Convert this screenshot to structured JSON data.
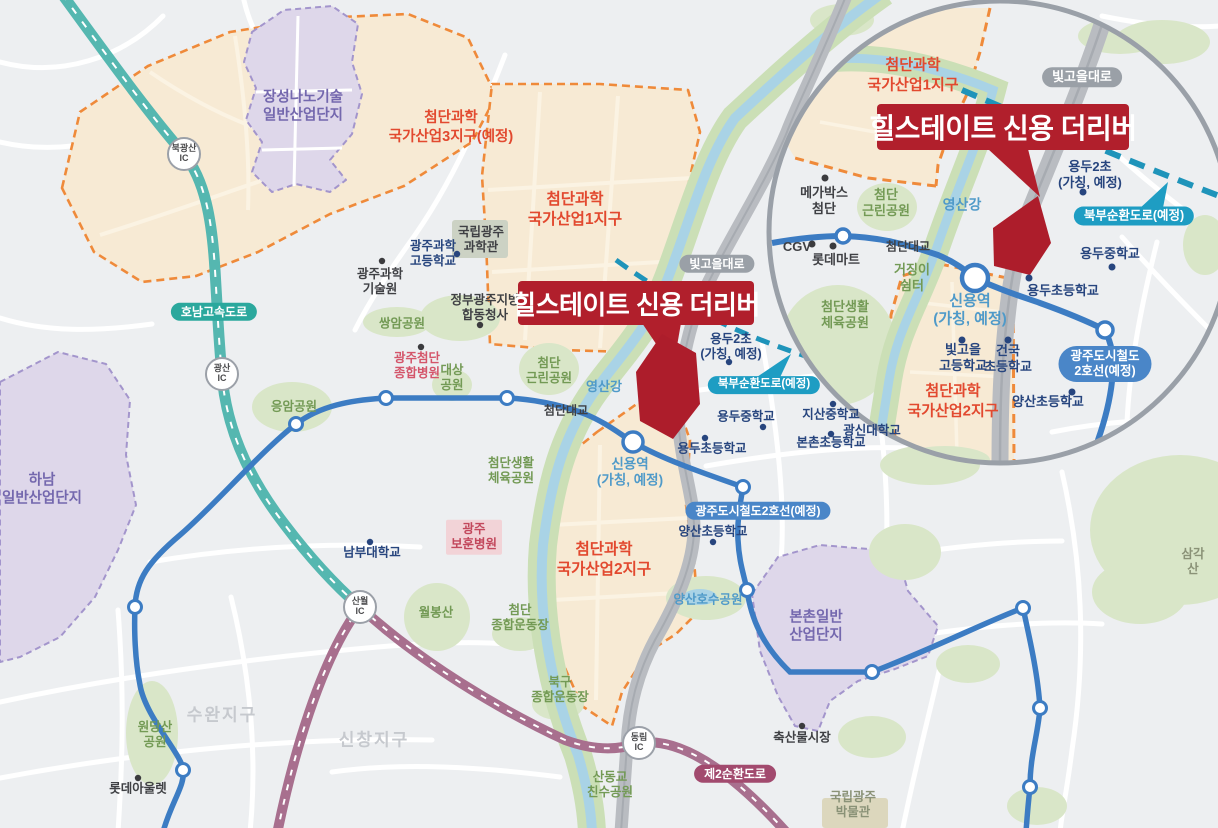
{
  "callout": {
    "title": "힐스테이트 신용 더리버"
  },
  "colors": {
    "brand_red": "#b11f2c",
    "zone_orange": "#ef8a3a",
    "zone_fill": "#f7ead4",
    "metro_blue": "#3c7cc3",
    "highway_teal": "#2ba89d",
    "ring_maroon": "#a86f8e",
    "planned_cyan": "#1e9dc3",
    "road_gray": "#b9bcc1",
    "park_green": "#d9e6c8",
    "river_blue": "#a9d3e6",
    "purple_zone": "#ded7ea"
  },
  "main": {
    "zones": {
      "z3": "첨단과학\n국가산업3지구(예정)",
      "z1": "첨단과학\n국가산업1지구",
      "z2": "첨단과학\n국가산업2지구",
      "jangseong": "장성나노기술\n일반산업단지",
      "hanam": "하남\n일반산업단지",
      "bonchon": "본촌일반\n산업단지"
    },
    "roads": {
      "honam": "호남고속도로",
      "ring2": "제2순환도로",
      "bitgoeul": "빛고을대로",
      "north_ring": "북부순환도로(예정)",
      "metro2": "광주도시철도2호선(예정)"
    },
    "ics": {
      "bukgwangsan": "북광산\nIC",
      "gwangsan": "광산\nIC",
      "sanwol": "산월\nIC",
      "dongnim": "동림\nIC"
    },
    "water": {
      "river": "영산강",
      "bridge": "첨단대교"
    },
    "stations": {
      "sinyong": "신용역\n(가칭, 예정)"
    },
    "districts": {
      "suwan": "수완지구",
      "sinchang": "신창지구"
    },
    "pois": {
      "gwahak_hs": "광주과학\n고등학교",
      "science_museum": "국립광주\n과학관",
      "gist": "광주과학\n기술원",
      "gov_complex": "정부광주지방\n합동청사",
      "ssangam": "쌍암공원",
      "cheomdan_hosp": "광주첨단\n종합병원",
      "daesang": "대상\n공원",
      "geunrin": "첨단\n근린공원",
      "sports": "첨단생활\n체육공원",
      "eungam": "응암공원",
      "nambu": "남부대학교",
      "bohun": "광주\n보훈병원",
      "yongdu2": "용두2초\n(가칭, 예정)",
      "yongdu_ms": "용두중학교",
      "yongdu_es": "용두초등학교",
      "jisan": "지산중학교",
      "gwangshin": "광신대학교",
      "bonchon_es": "본촌초등학교",
      "yangsan_es": "양산초등학교",
      "yangsan_lake": "양산호수공원",
      "wolbong": "월봉산",
      "cheomdan_stadium": "첨단\n종합운동장",
      "bukgu_stadium": "북구\n종합운동장",
      "sandonggyo": "산동교\n친수공원",
      "museum": "국립광주\n박물관",
      "livestock": "축산물시장",
      "wondangsan": "원당산\n공원",
      "lotte_outlet": "롯데아울렛",
      "samgaksan": "삼각산"
    }
  },
  "inset": {
    "zones": {
      "z1": "첨단과학\n국가산업1지구",
      "z2": "첨단과학\n국가산업2지구"
    },
    "roads": {
      "bitgoeul": "빛고을대로",
      "north_ring": "북부순환도로(예정)",
      "metro2": "광주도시철도\n2호선(예정)"
    },
    "water": {
      "river": "영산강",
      "bridge": "첨단대교"
    },
    "stations": {
      "sinyong": "신용역\n(가칭, 예정)"
    },
    "pois": {
      "megabox": "메가박스\n첨단",
      "cgv": "CGV",
      "lottemart": "롯데마트",
      "geojing": "거징이\n쉼터",
      "sports": "첨단생활\n체육공원",
      "geunrin": "첨단\n근린공원",
      "bitgoeul_hs": "빛고을\n고등학교",
      "geonguk": "건국\n초등학교",
      "yongdu2": "용두2초\n(가칭, 예정)",
      "yongdu_ms": "용두중학교",
      "yongdu_es": "용두초등학교",
      "yangsan_es": "양산초등학교"
    }
  }
}
